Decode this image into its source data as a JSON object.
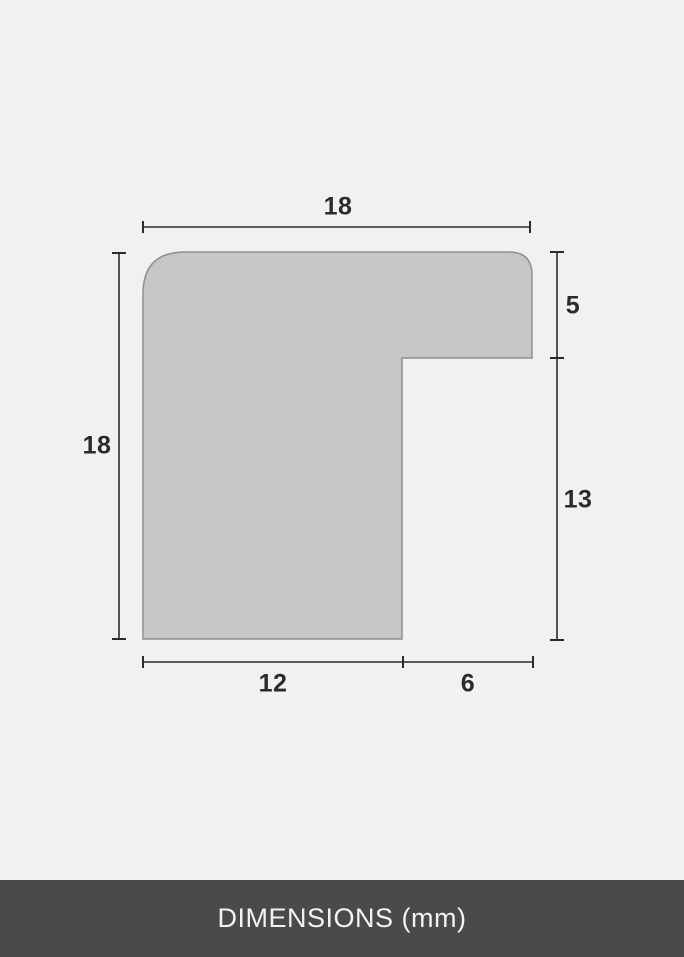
{
  "colors": {
    "background": "#f1f1f1",
    "shape_fill": "#c6c6c6",
    "shape_stroke": "#8f8f8f",
    "dimension_line": "#2b2b2b",
    "label_text": "#2b2b2b",
    "footer_bg": "#4a4a4a",
    "footer_text": "#f2f2f2"
  },
  "diagram": {
    "type": "frame-profile-cross-section",
    "unit": "mm",
    "dimensions": {
      "top": "18",
      "left": "18",
      "right_top": "5",
      "right_bottom": "13",
      "bottom_left": "12",
      "bottom_right": "6"
    }
  },
  "footer": {
    "label": "DIMENSIONS (mm)"
  }
}
